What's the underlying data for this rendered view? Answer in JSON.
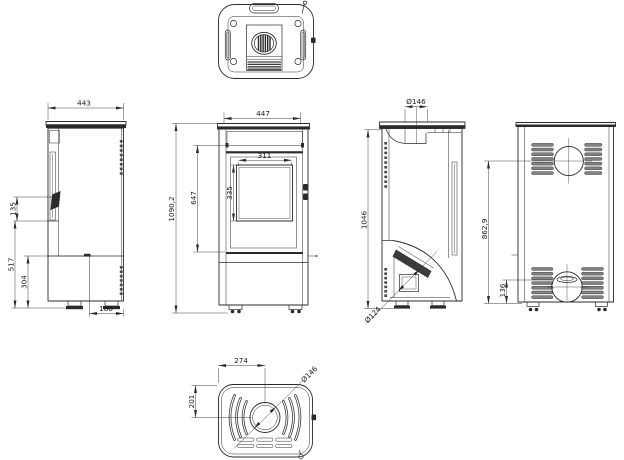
{
  "drawing": {
    "background": "#ffffff",
    "line_color": "#2b2b2b",
    "views": {
      "left": {
        "depth": "443",
        "handle_height": "135",
        "height_517": "517",
        "height_304": "304",
        "depth_186": "186"
      },
      "front": {
        "width": "447",
        "total_height": "1090,2",
        "door_height": "647",
        "glass_width": "311",
        "glass_height": "335"
      },
      "right": {
        "flue_diameter": "Ø146",
        "height_1046": "1046",
        "intake_diameter": "Ø124"
      },
      "rear": {
        "flue_center_height": "862,9",
        "intake_center_height": "136"
      },
      "bottom": {
        "flue_offset_depth": "274",
        "flue_offset_side": "201",
        "flue_diameter": "Ø146"
      }
    }
  }
}
